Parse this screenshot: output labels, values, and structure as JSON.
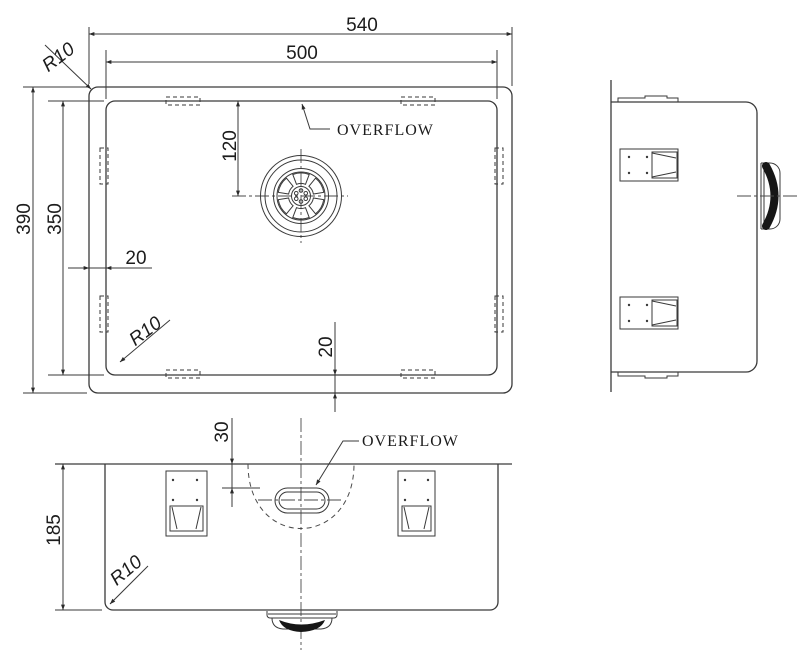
{
  "drawing": {
    "background": "#ffffff",
    "line_color": "#3a3a3a",
    "text_color": "#1c1c1c",
    "top_view": {
      "dim_outer_width": "540",
      "dim_inner_width": "500",
      "dim_outer_depth": "390",
      "dim_inner_depth": "350",
      "dim_drain_from_top": "120",
      "dim_left_gap": "20",
      "dim_bottom_gap": "20",
      "radius_outer_corner": "R10",
      "radius_inner_corner": "R10",
      "overflow_label": "OVERFLOW"
    },
    "front_view": {
      "dim_bowl_depth": "185",
      "dim_overflow_from_rim": "30",
      "radius_corner": "R10",
      "overflow_label": "OVERFLOW"
    }
  }
}
